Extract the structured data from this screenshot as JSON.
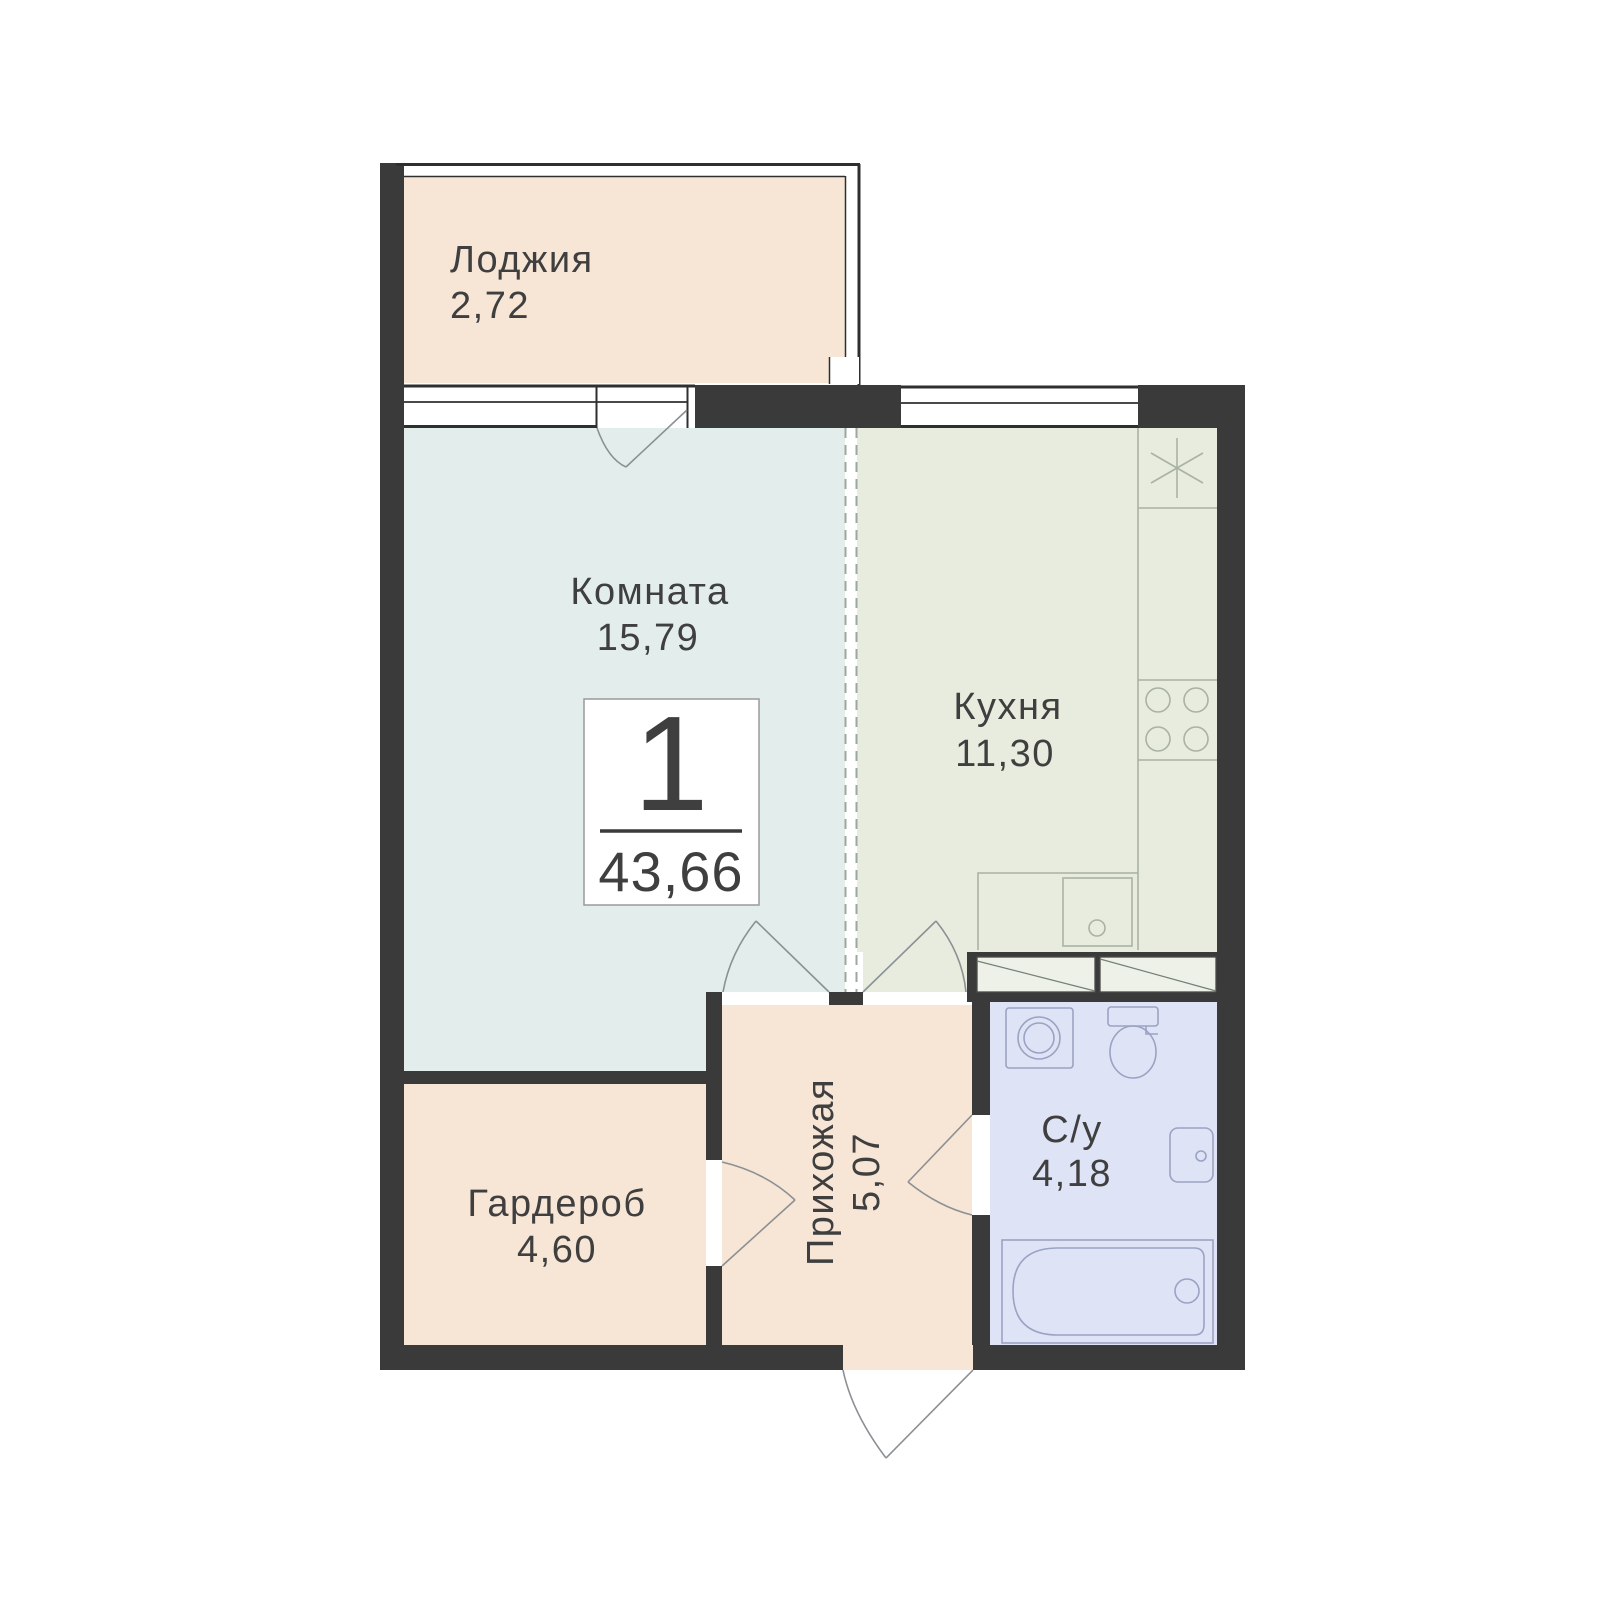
{
  "palette": {
    "wall": "#3a3a3a",
    "thin_line": "#2f2f2f",
    "loggia": "#f7e5d6",
    "room": "#e3eeec",
    "kitchen": "#e7ecde",
    "hallway": "#f7e5d6",
    "wardrobe": "#f7e5d6",
    "bathroom": "#dfe3f6",
    "vent_box": "#edf1e8",
    "fixture_green": "#a9b2a3",
    "fixture_blue": "#9aa3c4",
    "door_arc": "#8b9094",
    "dashed_zone": "#9ba89d",
    "text": "#3f3f3f",
    "badge_bg": "#ffffff",
    "badge_border": "#9a9a9a"
  },
  "badge": {
    "rooms_count": "1",
    "total_area": "43,66"
  },
  "rooms": {
    "loggia": {
      "label": "Лоджия",
      "area": "2,72"
    },
    "room": {
      "label": "Комната",
      "area": "15,79"
    },
    "kitchen": {
      "label": "Кухня",
      "area": "11,30"
    },
    "wardrobe": {
      "label": "Гардероб",
      "area": "4,60"
    },
    "hallway": {
      "label": "Прихожая",
      "area": "5,07"
    },
    "bathroom": {
      "label": "С/у",
      "area": "4,18"
    }
  }
}
